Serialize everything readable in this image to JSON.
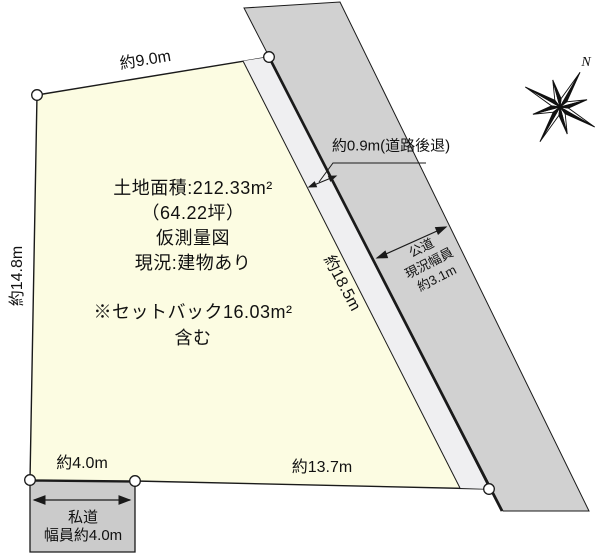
{
  "diagram": {
    "area_lines": [
      "土地面積:212.33m²",
      "（64.22坪）",
      "仮測量図",
      "現況:建物あり"
    ],
    "setback_lines": [
      "※セットバック16.03m²",
      "含む"
    ]
  },
  "dimensions": {
    "top_edge": "約9.0m",
    "left_edge": "約14.8m",
    "right_edge": "約18.5m",
    "bottom_edge": "約13.7m",
    "bottom_left_edge": "約4.0m",
    "setback_depth": "約0.9m(道路後退)"
  },
  "public_road": {
    "line1": "公道",
    "line2": "現況幅員",
    "line3": "約3.1m"
  },
  "private_road": {
    "line1": "私道",
    "line2": "幅員約4.0m"
  },
  "compass": {
    "north": "N"
  },
  "colors": {
    "plot_fill": "#FCFCE2",
    "setback_strip_fill": "#EFEFF1",
    "public_road_fill": "#D1D1D1",
    "private_road_fill": "#CBCBCB",
    "line_color": "#1A1A1A"
  }
}
